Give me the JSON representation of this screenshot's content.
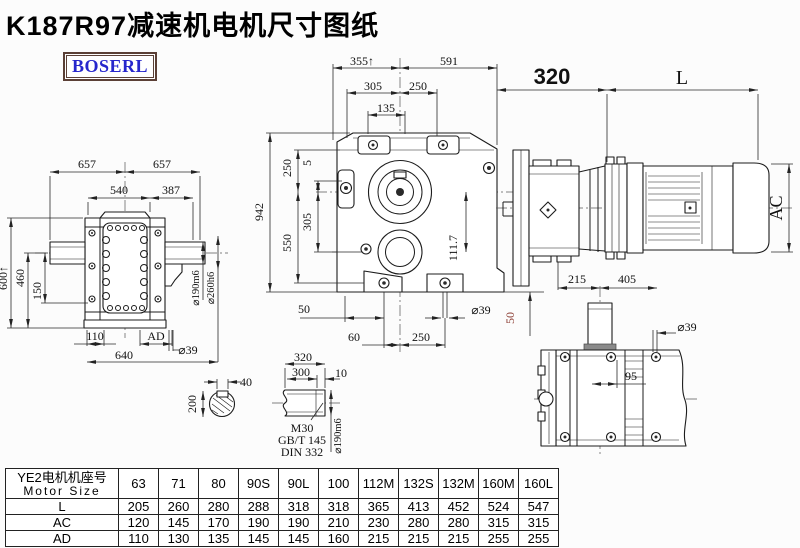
{
  "title": "K187R97减速机电机尺寸图纸",
  "logo": {
    "text": "BOSERL"
  },
  "colors": {
    "line": "#1c1c1c",
    "accent_red": "#8b3c32",
    "logo_blue": "#2626cc",
    "logo_border": "#5b4036"
  },
  "front_view": {
    "dim_width_left": "355↑",
    "dim_width_right": "591",
    "dim_305_top": "305",
    "dim_250_top": "250",
    "dim_135": "135",
    "dim_total_height": "942",
    "dim_250_left": "250",
    "dim_5": "5",
    "dim_305_left": "305",
    "dim_550": "550",
    "dim_50_foot": "50",
    "dim_60": "60",
    "dim_250_bottom": "250",
    "dim_bolt_dia": "⌀39",
    "dim_50_side": "50",
    "dim_111_7": "111.7"
  },
  "side_view": {
    "dim_657_left": "657",
    "dim_657_right": "657",
    "dim_540": "540",
    "dim_387": "387",
    "dim_600": "600↑",
    "dim_460": "460",
    "dim_150": "150",
    "dim_110": "110",
    "dim_ad": "AD",
    "dim_640": "640",
    "dim_bolt_dia": "⌀39",
    "dim_shaft_dia": "⌀190m6",
    "dim_flange_dia": "⌀260h6"
  },
  "motor_view": {
    "dim_320": "320",
    "dim_l": "L",
    "dim_ac": "AC",
    "dim_215": "215",
    "dim_405": "405"
  },
  "top_view": {
    "dim_bolt_dia": "⌀39",
    "dim_95": "95"
  },
  "shaft_section": {
    "dim_key_width": "40",
    "dim_dia": "200"
  },
  "shaft_detail": {
    "dim_320": "320",
    "dim_300": "300",
    "dim_10": "10",
    "thread": "M30",
    "std_gb": "GB/T 145",
    "std_din": "DIN 332",
    "dim_dia": "⌀190m6"
  },
  "table": {
    "header_cn": "YE2电机机座号",
    "header_en": "Motor Size",
    "columns": [
      "63",
      "71",
      "80",
      "90S",
      "90L",
      "100",
      "112M",
      "132S",
      "132M",
      "160M",
      "160L"
    ],
    "rows": [
      {
        "label": "L",
        "values": [
          "205",
          "260",
          "280",
          "288",
          "318",
          "318",
          "365",
          "413",
          "452",
          "524",
          "547"
        ]
      },
      {
        "label": "AC",
        "values": [
          "120",
          "145",
          "170",
          "190",
          "190",
          "210",
          "230",
          "280",
          "280",
          "315",
          "315"
        ]
      },
      {
        "label": "AD",
        "values": [
          "110",
          "130",
          "135",
          "145",
          "145",
          "160",
          "215",
          "215",
          "215",
          "255",
          "255"
        ]
      }
    ]
  }
}
